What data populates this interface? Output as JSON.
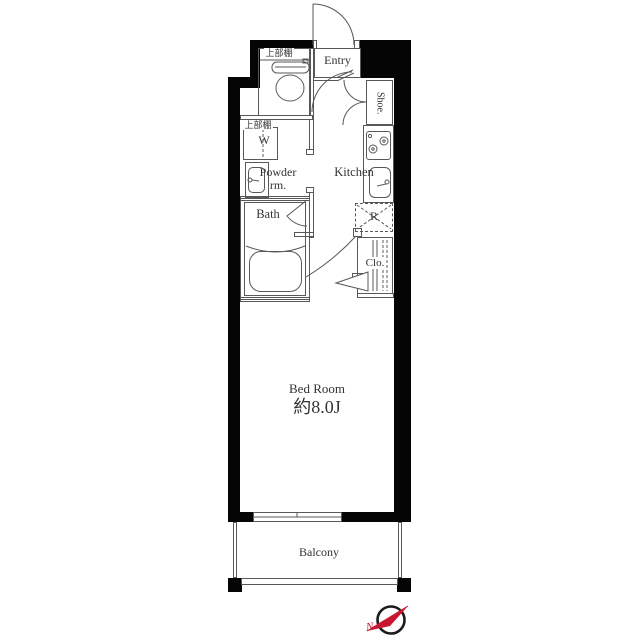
{
  "labels": {
    "entry": "Entry",
    "shoe": "Shoe.",
    "kitchen": "Kitchen",
    "powder1": "Powder",
    "powder2": "rm.",
    "bath": "Bath",
    "washer": "W",
    "fridge": "R",
    "closet": "Clo.",
    "bedroom_name": "Bed Room",
    "bedroom_size": "約8.0J",
    "balcony": "Balcony",
    "shelf_toilet": "上部棚",
    "shelf_laundry": "上部棚",
    "compass_north": "N"
  },
  "icons": {
    "toilet": "toilet-icon",
    "bathtub": "bathtub-icon",
    "stove": "stove-burners-icon",
    "kitchen_sink": "kitchen-sink-icon",
    "vanity_sink": "vanity-sink-icon",
    "compass": "compass-north-icon",
    "door_swings": "door-swing-arc"
  },
  "colors": {
    "wall": "#050505",
    "line": "#585858",
    "text": "#333333",
    "compass_red": "#c81632"
  }
}
